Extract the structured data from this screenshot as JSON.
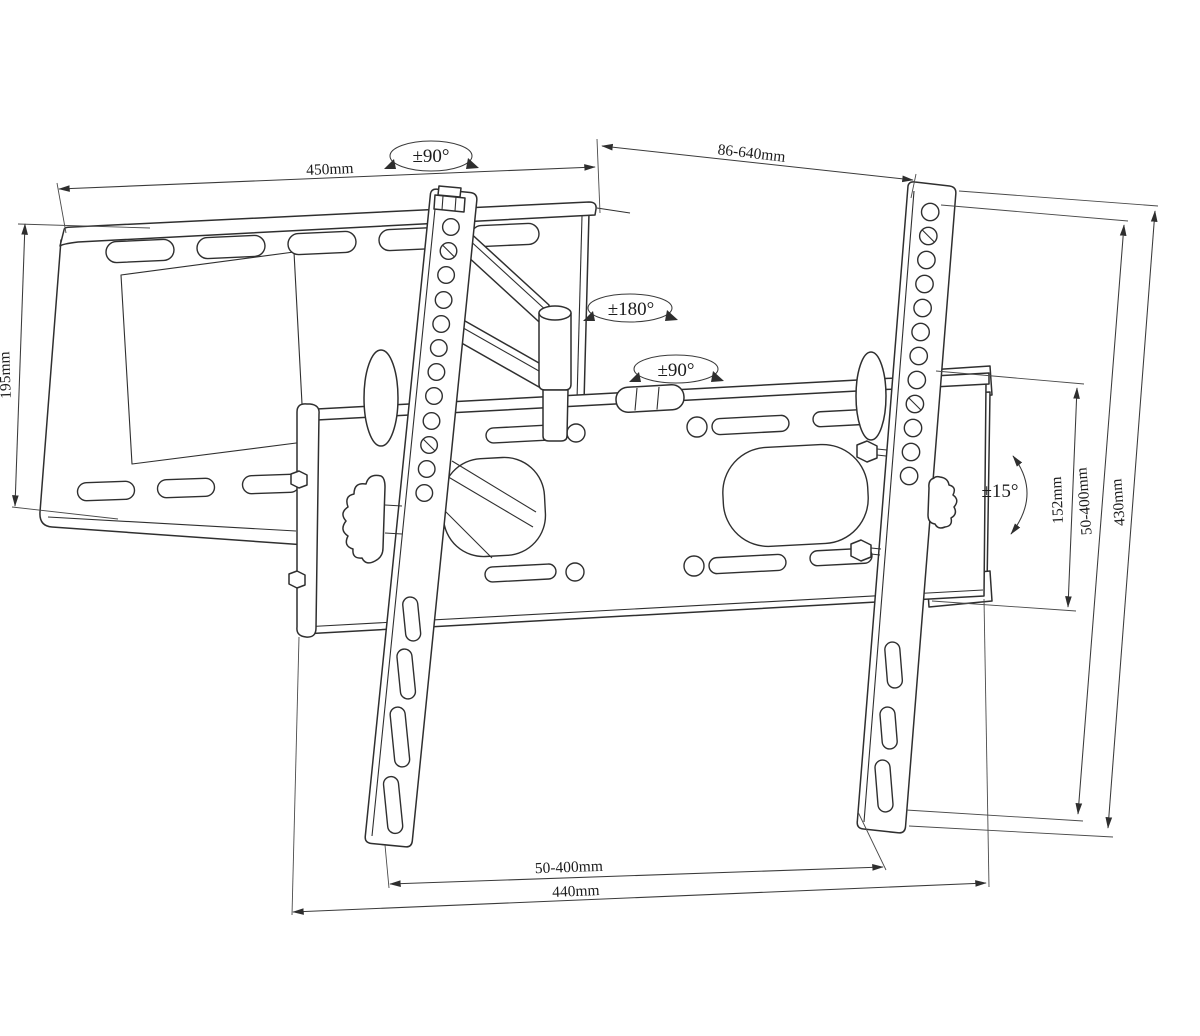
{
  "drawing": {
    "kind": "technical-line-drawing",
    "subject": "articulating TV wall mount bracket"
  },
  "colors": {
    "background": "#ffffff",
    "part_line": "#2f2f2f",
    "dimension_line": "#3a3a3a",
    "text": "#1c1c1c"
  },
  "labels": {
    "wall_plate_width": "450mm",
    "swivel_top": "±90°",
    "extension_range": "86-640mm",
    "arm_rotation": "±180°",
    "swivel_mid": "±90°",
    "wall_plate_height": "195mm",
    "tilt_range": "±15°",
    "bracket_height": "152mm",
    "vesa_vertical_range": "50-400mm",
    "rail_length": "430mm",
    "vesa_horizontal_range": "50-400mm",
    "bracket_width": "440mm"
  }
}
